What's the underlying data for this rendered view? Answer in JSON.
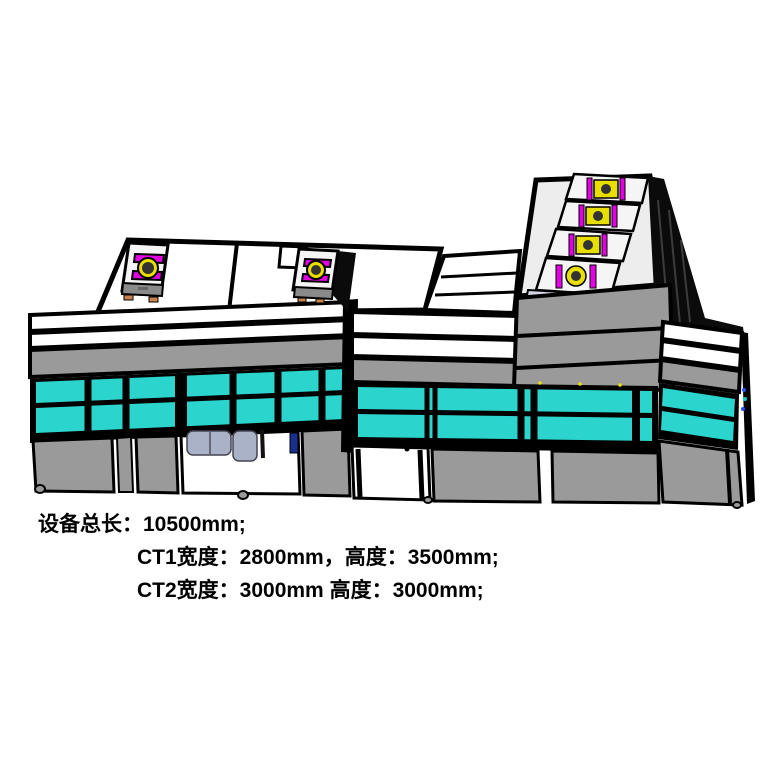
{
  "annotations": {
    "line1": "设备总长：10500mm;",
    "line2": "CT1宽度：2800mm，高度：3500mm;",
    "line3": "CT2宽度：3000mm 高度：3000mm;"
  },
  "dimensions": {
    "total_length": "10500mm",
    "ct1_width": "2800mm",
    "ct1_height": "3500mm",
    "ct2_width": "3000mm",
    "ct2_height": "3000mm"
  },
  "equipment": {
    "ct1_roof_fan_units": 2,
    "ct2_tower_fan_units": 4
  },
  "colors": {
    "white": "#ffffff",
    "window_cyan": "#2bd4cd",
    "panel_gray": "#9a9a9a",
    "ffu_magenta": "#e300e3",
    "ffu_yellow": "#e8df00",
    "fan_dark": "#333333",
    "ffu_base_gray": "#8a8a8a",
    "feet_tan": "#c8824b",
    "equipment_blue": "#a9b2c7",
    "accent_navy": "#1a2e8c",
    "rim_lavender": "#d6d7e4",
    "tower_shadow": "#0b0b0b",
    "outline_black": "#000000"
  }
}
